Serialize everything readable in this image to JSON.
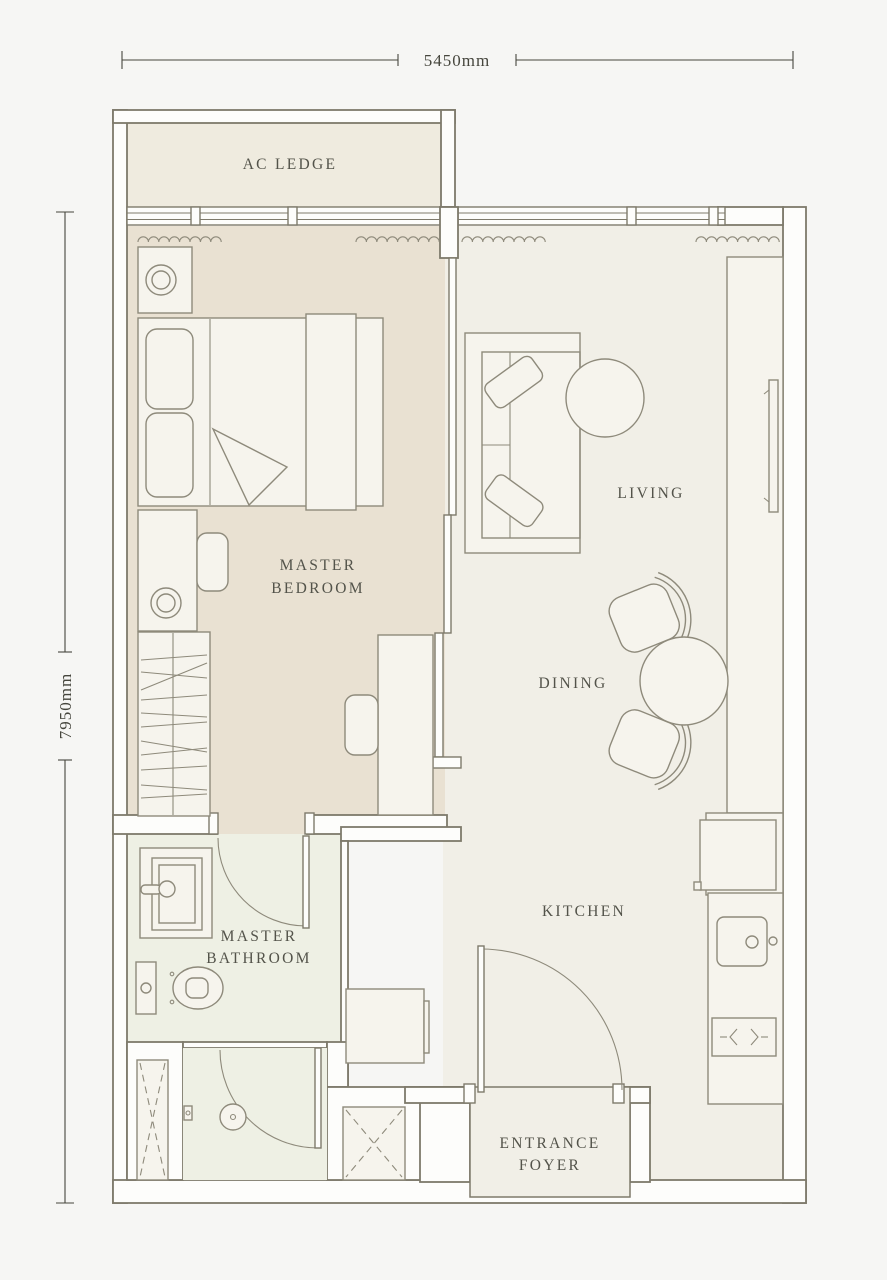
{
  "plan": {
    "dimension_width": "5450mm",
    "dimension_height": "7950mm",
    "rooms": {
      "ac_ledge": "AC LEDGE",
      "master_bedroom": {
        "line1": "MASTER",
        "line2": "BEDROOM"
      },
      "living": "LIVING",
      "dining": "DINING",
      "kitchen": "KITCHEN",
      "master_bathroom": {
        "line1": "MASTER",
        "line2": "BATHROOM"
      },
      "entrance_foyer": {
        "line1": "ENTRANCE",
        "line2": "FOYER"
      }
    }
  },
  "colors": {
    "background": "#f6f6f4",
    "floor_main": "#f1efe7",
    "floor_bedroom": "#e9e1d2",
    "floor_bathroom": "#eef0e4",
    "floor_ledge": "#efebdf",
    "wall_fill": "#fdfdfb",
    "wall_stroke": "#7e7a6b",
    "furniture_stroke": "#8e8a7b",
    "furniture_fill": "#f6f4ed",
    "text": "#53534a",
    "dimension": "#46463d"
  }
}
